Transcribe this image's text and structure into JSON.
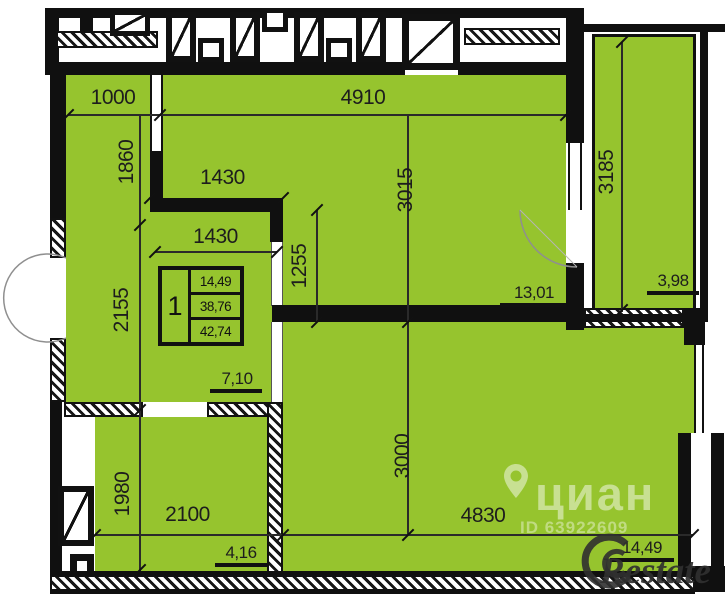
{
  "plan_title": "apartment-floor-plan",
  "colors": {
    "room_fill": "#96c42e",
    "wall": "#101010",
    "dim_text": "#1d1d1d",
    "watermark_white": "rgba(255,255,255,0.48)",
    "watermark_gray": "rgba(48,48,48,0.92)"
  },
  "dims": {
    "d1000": "1000",
    "d4910": "4910",
    "d1860": "1860",
    "d2155": "2155",
    "d1430a": "1430",
    "d1430b": "1430",
    "d3015": "3015",
    "d1255": "1255",
    "d3185": "3185",
    "d1980": "1980",
    "d2100": "2100",
    "d3000": "3000",
    "d4830": "4830"
  },
  "areas": {
    "main_room": "13,01",
    "balcony": "3,98",
    "hall": "7,10",
    "bathroom": "4,16",
    "kitchen": "14,49"
  },
  "unit": {
    "rooms": "1",
    "living_area": "14,49",
    "usable_area": "38,76",
    "total_area": "42,74"
  },
  "watermark": {
    "brand": "циан",
    "listing_id": "ID 63922609",
    "agency": "Restate"
  }
}
